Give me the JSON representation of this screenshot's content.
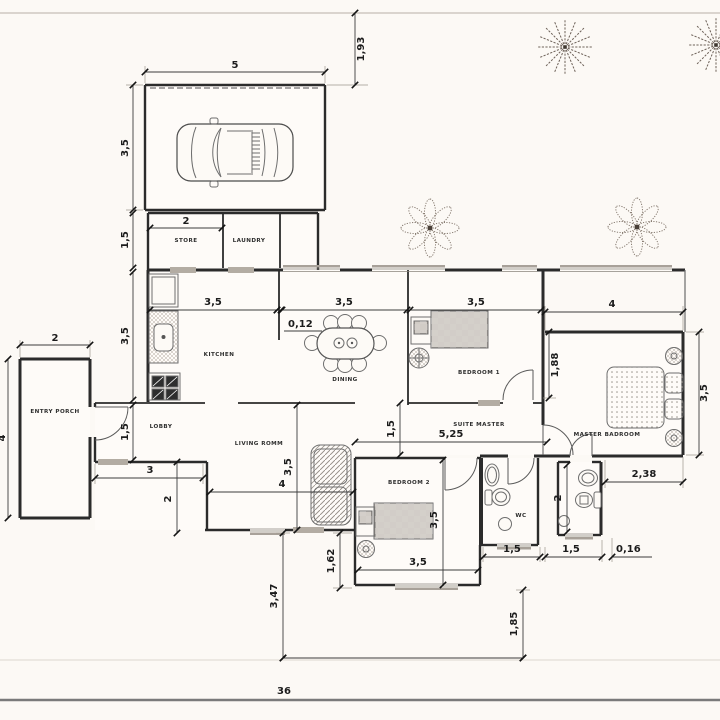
{
  "rooms": {
    "entry_porch": "ENTRY PORCH",
    "lobby": "LOBBY",
    "store": "STORE",
    "laundry": "LAUNDRY",
    "kitchen": "KITCHEN",
    "dining": "DINING",
    "living_room": "LIVING ROMM",
    "bedroom1": "BEDROOM 1",
    "bedroom2": "BEDROOM 2",
    "suite_master": "SUITE MASTER",
    "master_bedroom": "MASTER BADROOM",
    "wc": "WC"
  },
  "dims": {
    "garage_w": "5",
    "garage_h": "3,5",
    "top_setback": "1,93",
    "store_h": "1,5",
    "store_w": "2",
    "kitchen_w": "3,5",
    "dining_w": "3,5",
    "bedroom1_w": "3,5",
    "wall_t": "0,12",
    "master_w": "4",
    "bedroom1_side": "1,88",
    "master_h": "3,5",
    "master_offset": "2,38",
    "porch_w": "2",
    "porch_h": "4",
    "kitchen_h": "3,5",
    "lobby_h": "1,5",
    "step_w": "3",
    "step_h": "2",
    "living_w": "4",
    "living_h": "3,5",
    "corridor_h": "1,5",
    "corridor_w": "5,25",
    "bedroom2_h": "3,5",
    "bedroom2_w": "3,5",
    "bedroom2_ext": "1,62",
    "wc_w": "1,5",
    "bath2_w": "1,5",
    "right_wall": "0,16",
    "bath2_h": "2",
    "site_left_v": "3,47",
    "site_right_v": "1,85",
    "site_w": "36"
  },
  "colors": {
    "paper": "#fcf9f5",
    "wall": "#2b2b2b",
    "dim_text": "#1c1c1c"
  }
}
